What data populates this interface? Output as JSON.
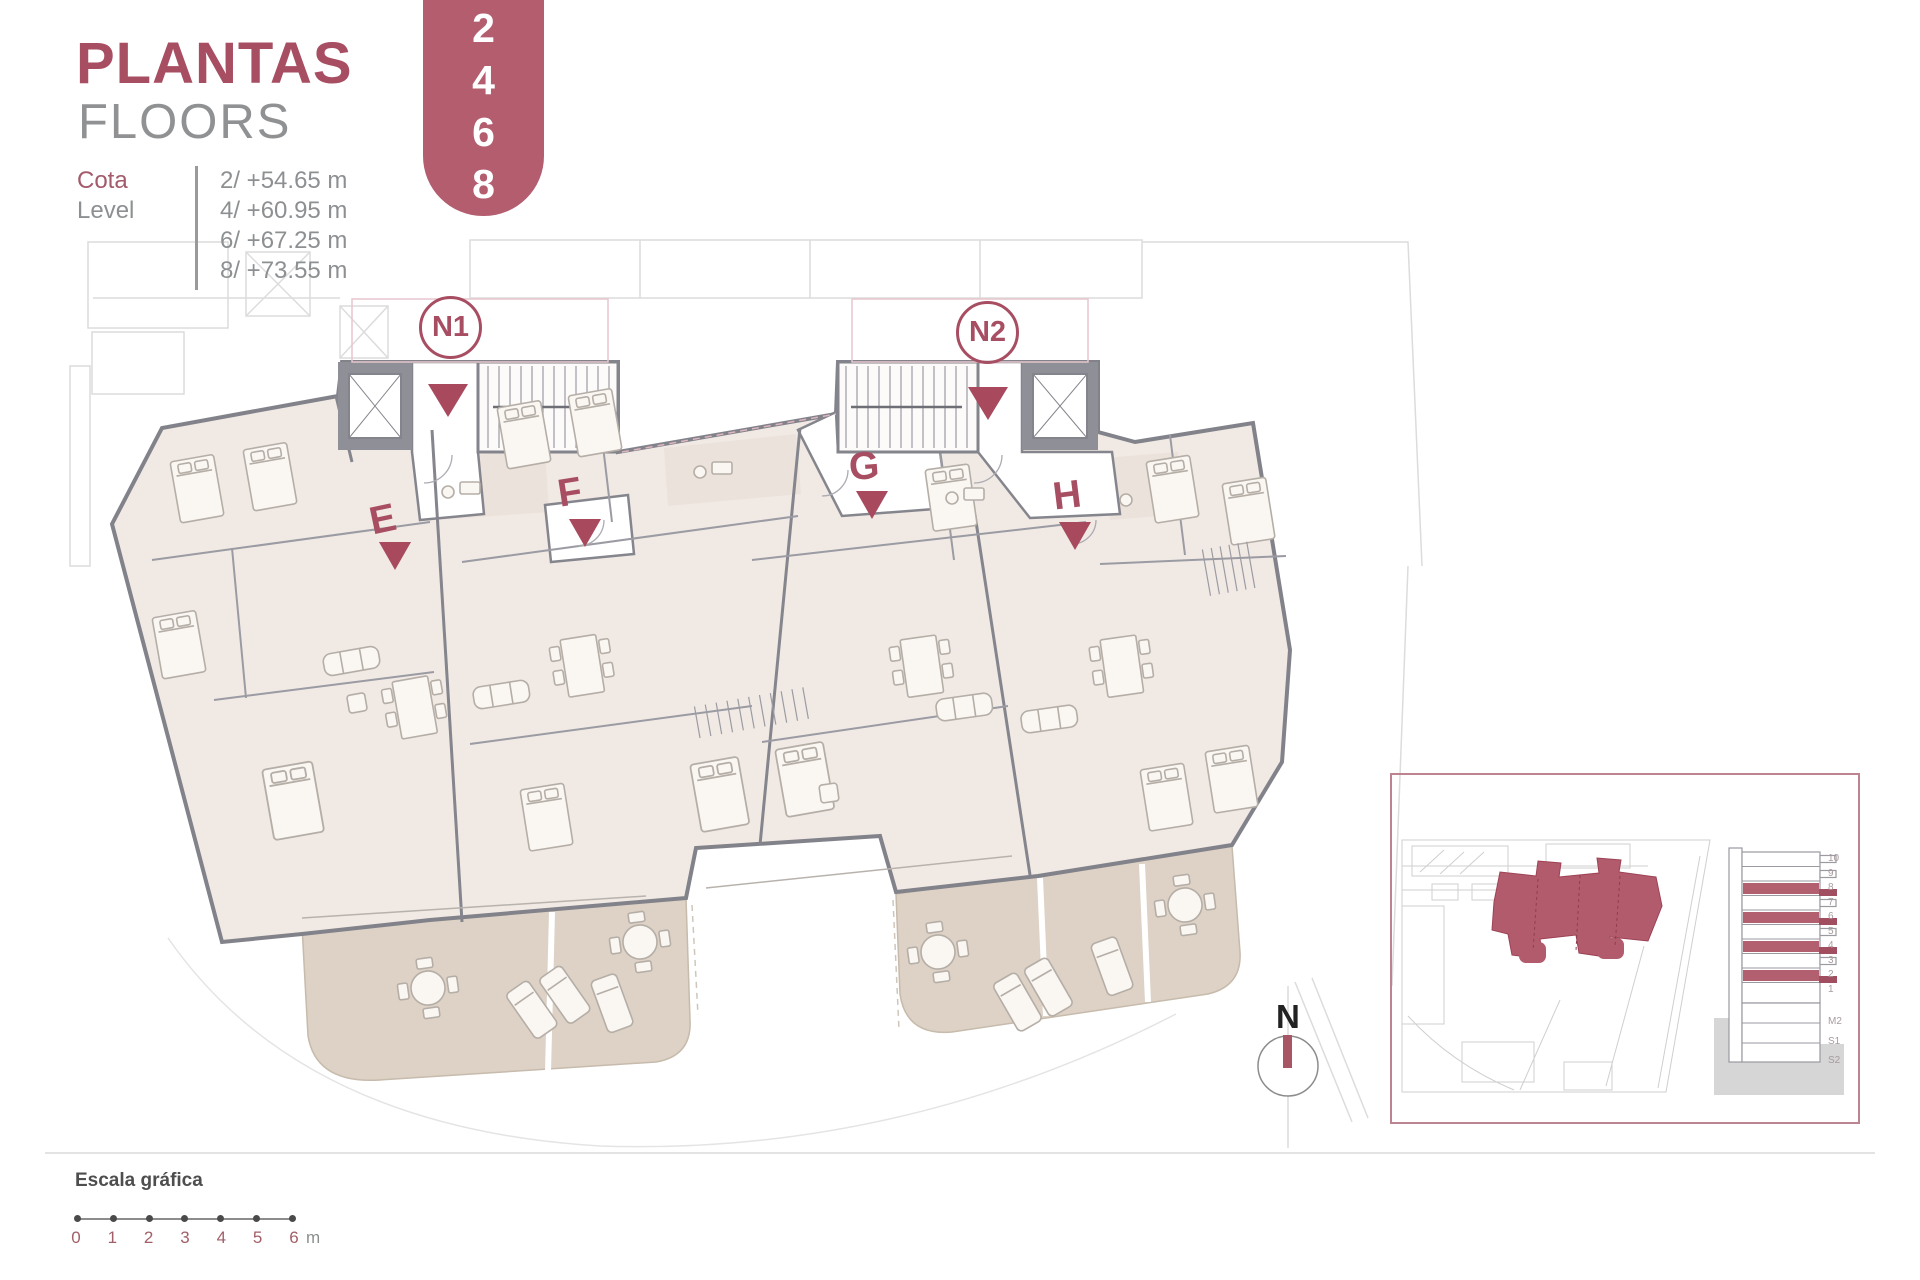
{
  "accent_color": "#ab4e62",
  "header": {
    "title": "PLANTAS",
    "subtitle": "FLOORS",
    "floor_badge": [
      "2",
      "4",
      "6",
      "8"
    ]
  },
  "levels": {
    "label_es": "Cota",
    "label_en": "Level",
    "items": [
      "2/ +54.65 m",
      "4/ +60.95 m",
      "6/ +67.25 m",
      "8/ +73.55 m"
    ]
  },
  "plan": {
    "cores": [
      {
        "label": "N1"
      },
      {
        "label": "N2"
      }
    ],
    "units": [
      {
        "label": "E"
      },
      {
        "label": "F"
      },
      {
        "label": "G"
      },
      {
        "label": "H"
      }
    ]
  },
  "compass": {
    "label": "N"
  },
  "inset": {
    "section_floors_upper": [
      "10",
      "9",
      "8",
      "7",
      "6",
      "5",
      "4",
      "3",
      "2",
      "1"
    ],
    "section_floors_lower": [
      "M2",
      "S1",
      "S2"
    ],
    "highlighted_floors": [
      "2",
      "4",
      "6",
      "8"
    ]
  },
  "scale": {
    "label": "Escala gráfica",
    "ticks": [
      "0",
      "1",
      "2",
      "3",
      "4",
      "5",
      "6"
    ],
    "unit": "m"
  }
}
